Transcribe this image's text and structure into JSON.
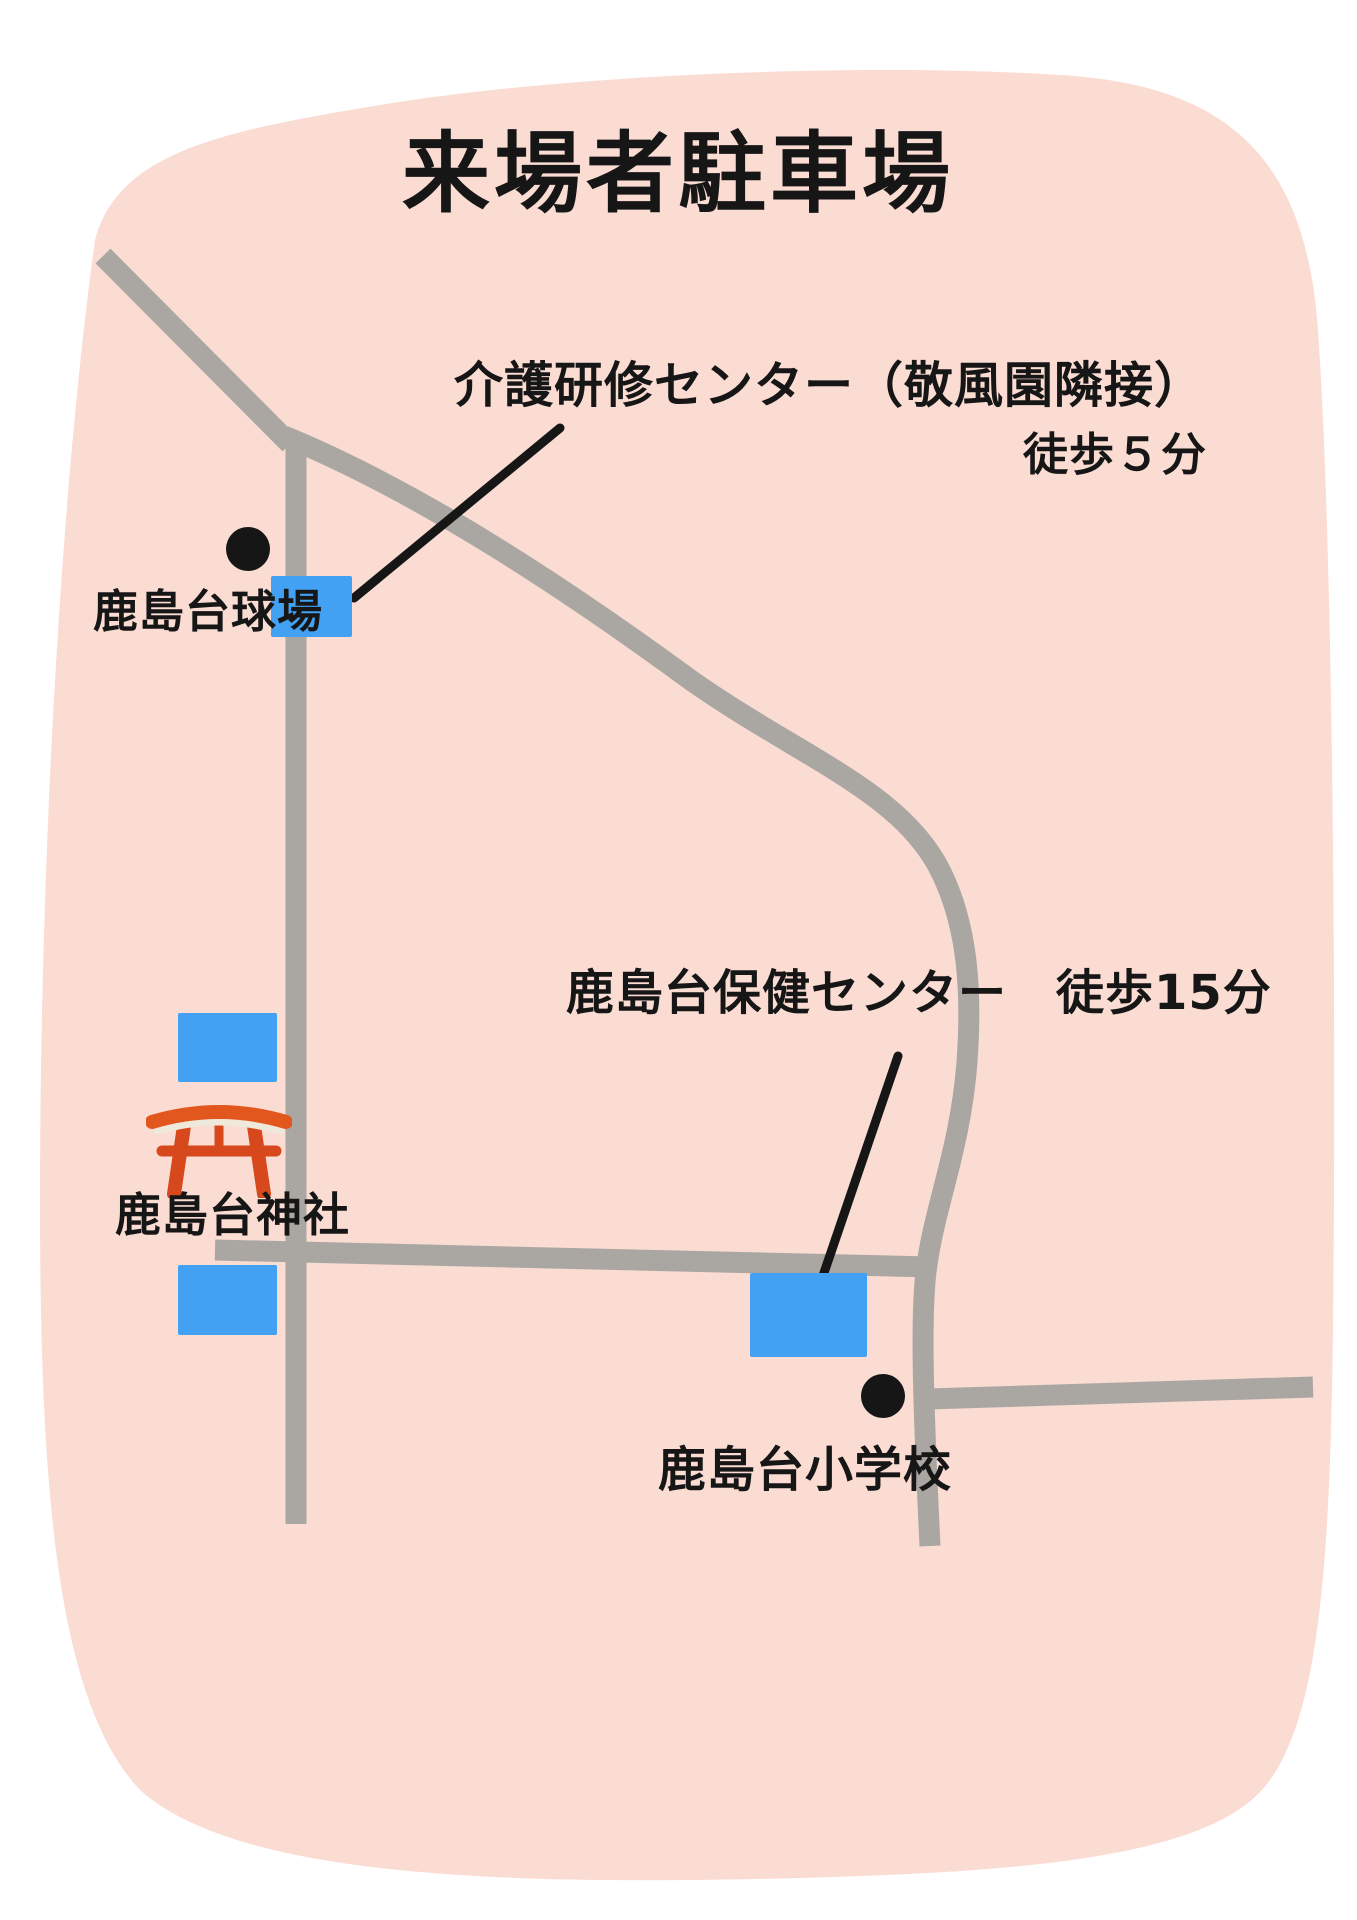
{
  "title": "来場者駐車場",
  "labels": {
    "training_center_line1": "介護研修センター（敬風園隣接）",
    "training_center_line2": "徒歩５分",
    "ballpark": "鹿島台球場",
    "health_center": "鹿島台保健センター　徒歩15分",
    "shrine": "鹿島台神社",
    "school": "鹿島台小学校"
  },
  "icons": {
    "torii": "torii-gate-icon",
    "ballpark_marker": "landmark-dot-icon",
    "school_marker": "landmark-dot-icon",
    "parking_marker": "blue-parking-rectangle"
  },
  "colors": {
    "page_background": "#ffffff",
    "map_area_pink": "#fbdcd3",
    "road_gray": "#aaa7a3",
    "parking_blue": "#42a1f2",
    "torii_orange": "#e2571e",
    "torii_red": "#d7481c",
    "text_black": "#161616"
  }
}
